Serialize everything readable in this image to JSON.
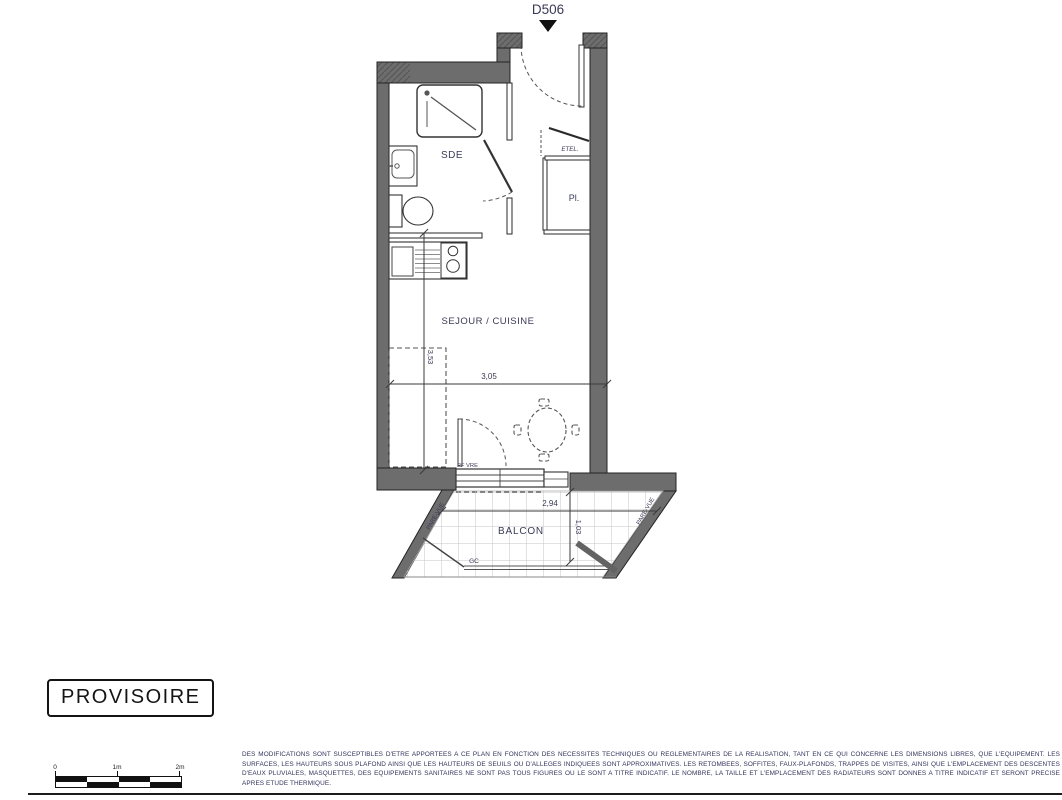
{
  "plan": {
    "unit_label": "D506",
    "rooms": {
      "sde": "SDE",
      "closet": "Pl.",
      "closet_shelf": "ETEL.",
      "living": "SEJOUR / CUISINE",
      "balcony": "BALCON"
    },
    "labels": {
      "window": "PF VRE",
      "railing": "GC",
      "screen_left": "PARE-VUE",
      "screen_right": "PARE-VUE"
    },
    "dimensions": {
      "living_width": "3,05",
      "living_height": "3,53",
      "balcony_width": "2,94",
      "balcony_depth": "1,03"
    }
  },
  "stamp": {
    "label": "PROVISOIRE"
  },
  "scale_bar": {
    "ticks": [
      "0",
      "1m",
      "2m"
    ]
  },
  "disclaimer": {
    "text": "DES MODIFICATIONS SONT SUSCEPTIBLES D'ETRE APPORTEES A CE PLAN EN FONCTION DES NECESSITES TECHNIQUES OU REGLEMENTAIRES DE LA REALISATION, TANT EN CE QUI CONCERNE LES DIMENSIONS LIBRES, QUE L'EQUIPEMENT. LES SURFACES, LES HAUTEURS SOUS PLAFOND AINSI QUE LES HAUTEURS DE SEUILS OU D'ALLEGES INDIQUEES SONT APPROXIMATIVES. LES RETOMBEES, SOFFITES, FAUX-PLAFONDS, TRAPPES DE VISITES, AINSI QUE L'EMPLACEMENT DES DESCENTES D'EAUX PLUVIALES, MASQUETTES, DES EQUIPEMENTS SANITAIRES NE SONT PAS TOUS FIGURES OU LE SONT A TITRE INDICATIF. LE NOMBRE, LA TAILLE ET L'EMPLACEMENT DES RADIATEURS SONT DONNES A TITRE INDICATIF ET SERONT PRECISE APRES ETUDE THERMIQUE."
  },
  "colors": {
    "wall": "#6d6d6d",
    "ink": "#33335a"
  }
}
